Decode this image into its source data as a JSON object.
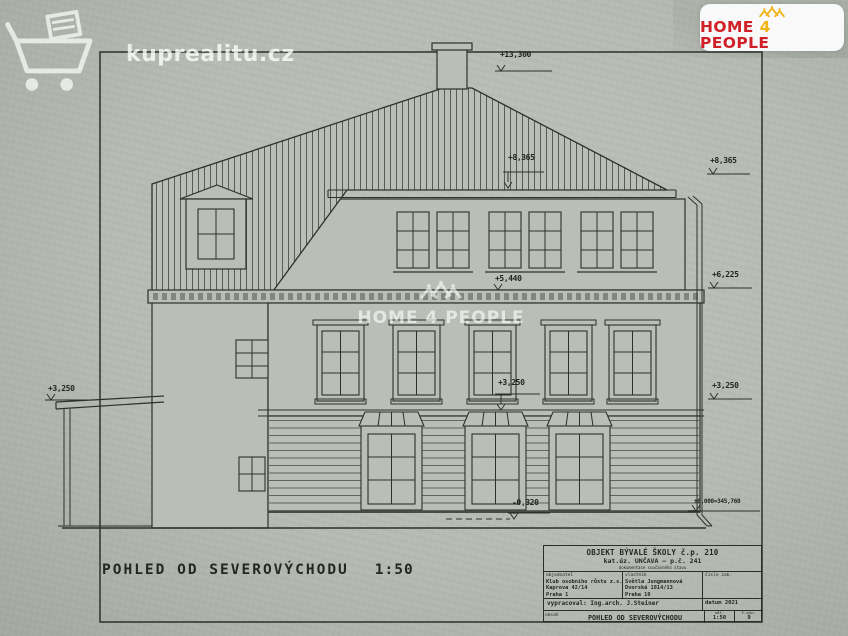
{
  "watermarks": {
    "top_left": {
      "text": "kuprealitu.cz",
      "icon": "shopping-cart"
    },
    "center": {
      "text": "HOME 4 PEOPLE",
      "icon": "crown-houses"
    }
  },
  "brand_badge": {
    "word1": "HOME",
    "word2": "4",
    "word3": "PEOPLE",
    "icon": "crown-houses",
    "color_red": "#cf2127",
    "color_yellow": "#f0b417"
  },
  "drawing": {
    "caption": {
      "title": "POHLED OD SEVEROVÝCHODU",
      "scale": "1:50"
    },
    "markers": [
      {
        "id": "chimney-top",
        "label": "+13,300"
      },
      {
        "id": "roof-eaves",
        "label": "+8,365"
      },
      {
        "id": "right-upper",
        "label": "+8,365"
      },
      {
        "id": "main-cornice",
        "label": "+5,440"
      },
      {
        "id": "right-middle",
        "label": "+6,225"
      },
      {
        "id": "sill-band",
        "label": "+3,250"
      },
      {
        "id": "porch-roof",
        "label": "+3,250"
      },
      {
        "id": "right-lower",
        "label": "+3,250"
      },
      {
        "id": "ground-recess",
        "label": "-0,320"
      },
      {
        "id": "datum-level",
        "label": "±0,000=345,760"
      }
    ]
  },
  "title_block": {
    "object_line1": "OBJEKT BÝVALÉ ŠKOLY č.p. 210",
    "object_line2": "kat.úz. UNČAVA  –  p.č. 241",
    "object_line3": "dokumentace současného stavu",
    "client": {
      "label": "objednatel",
      "line1": "Klub osobního růstu z.s.",
      "line2": "Kaprova 42/14",
      "line3": "Praha 1"
    },
    "owner": {
      "label": "vlastník",
      "line1": "Světla Jungmannová",
      "line2": "Dvorská 1814/13",
      "line3": "Praha 10"
    },
    "order_no": {
      "label": "číslo zak."
    },
    "author": {
      "label": "vypracoval:",
      "value": "Ing.arch. J.Steiner"
    },
    "date": {
      "label": "datum",
      "value": "2021"
    },
    "content": {
      "label": "obsah",
      "value": "POHLED OD SEVEROVÝCHODU"
    },
    "scale": {
      "label": "měř.",
      "value": "1:50"
    },
    "sheet": {
      "label": "č.výkr.",
      "value": "9"
    }
  }
}
